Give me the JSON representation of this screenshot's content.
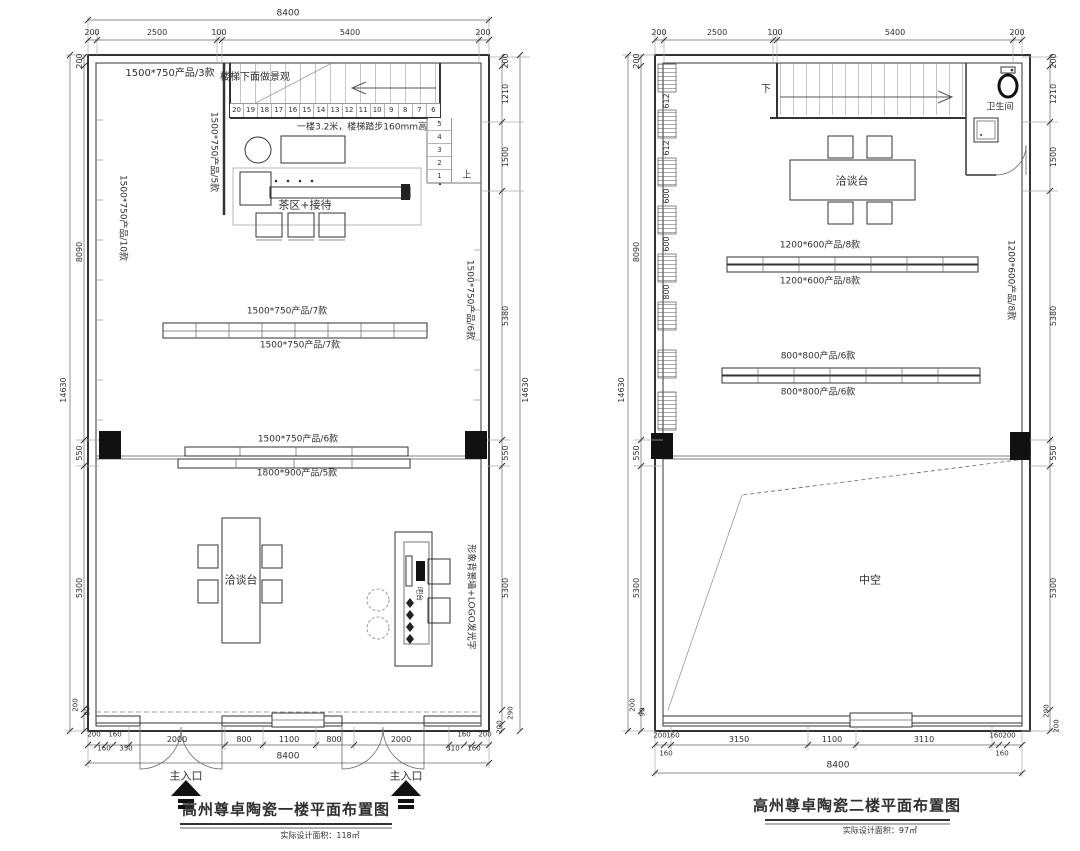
{
  "meta": {
    "ink_color": "#333333",
    "bg_color": "#ffffff"
  },
  "floor1": {
    "title": "高州尊卓陶瓷一楼平面布置图",
    "subtitle": "实际设计面积：118㎡",
    "labels": {
      "room_topleft": "1500*750产品/3款",
      "under_stairs": "楼梯下面做景观",
      "stair_note": "一楼3.2米，楼梯踏步160mm高",
      "tea_area": "茶区+接待",
      "up": "上",
      "rack_partition": "1500*750产品/5款",
      "rack_left_wall": "1500*750产品/10款",
      "rack_mid_top": "1500*750产品/7款",
      "rack_mid_bottom": "1500*750产品/7款",
      "rack_right_wall": "1500*750产品/6款",
      "rack_band_top": "1500*750产品/6款",
      "rack_band_bottom": "1800*900产品/5款",
      "table": "洽谈台",
      "bar": "吧台",
      "logo_wall": "形象背景墙+LOGO发光字",
      "entrance_left": "主入口",
      "entrance_right": "主入口"
    },
    "stairs": {
      "h": [
        "20",
        "19",
        "18",
        "17",
        "16",
        "15",
        "14",
        "13",
        "12",
        "11",
        "10",
        "9",
        "8",
        "7",
        "6"
      ],
      "v": [
        "5",
        "4",
        "3",
        "2",
        "1"
      ]
    },
    "dims": {
      "top_total": "8400",
      "top": [
        "200",
        "2500",
        "100",
        "5400",
        "200"
      ],
      "left_total": "14630",
      "left": [
        "200",
        "8090",
        "550",
        "5300",
        "90",
        "200"
      ],
      "right_total": "14630",
      "right": [
        "200",
        "1210",
        "1500",
        "5380",
        "550",
        "5300",
        "290",
        "200"
      ],
      "bottom_total": "8400",
      "bottom_main": [
        "2000",
        "800",
        "1100",
        "800",
        "2000"
      ],
      "bottom_small_left": [
        "200",
        "160",
        "160",
        "350"
      ],
      "bottom_small_right": [
        "160",
        "200",
        "310",
        "160"
      ]
    }
  },
  "floor2": {
    "title": "高州尊卓陶瓷二楼平面布置图",
    "subtitle": "实际设计面积：97㎡",
    "labels": {
      "down": "下",
      "bathroom": "卫生间",
      "table": "洽谈台",
      "row1_top": "1200*600产品/8款",
      "row1_bottom": "1200*600产品/8款",
      "row2_top": "800*800产品/6款",
      "row2_bottom": "800*800产品/6款",
      "rack_right_wall": "1200*600产品/8款",
      "void": "中空",
      "rack_segments": [
        "612",
        "612",
        "600",
        "600",
        "800"
      ]
    },
    "dims": {
      "top": [
        "200",
        "2500",
        "100",
        "5400",
        "200"
      ],
      "left_total": "14630",
      "left": [
        "200",
        "8090",
        "550",
        "5300",
        "200",
        "90"
      ],
      "right": [
        "200",
        "1210",
        "1500",
        "5380",
        "550",
        "5300",
        "290",
        "200"
      ],
      "bottom_total": "8400",
      "bottom_main": [
        "3150",
        "1100",
        "3110"
      ],
      "bottom_small_left": [
        "200",
        "160",
        "160"
      ],
      "bottom_small_right": [
        "160",
        "200",
        "160"
      ]
    }
  }
}
